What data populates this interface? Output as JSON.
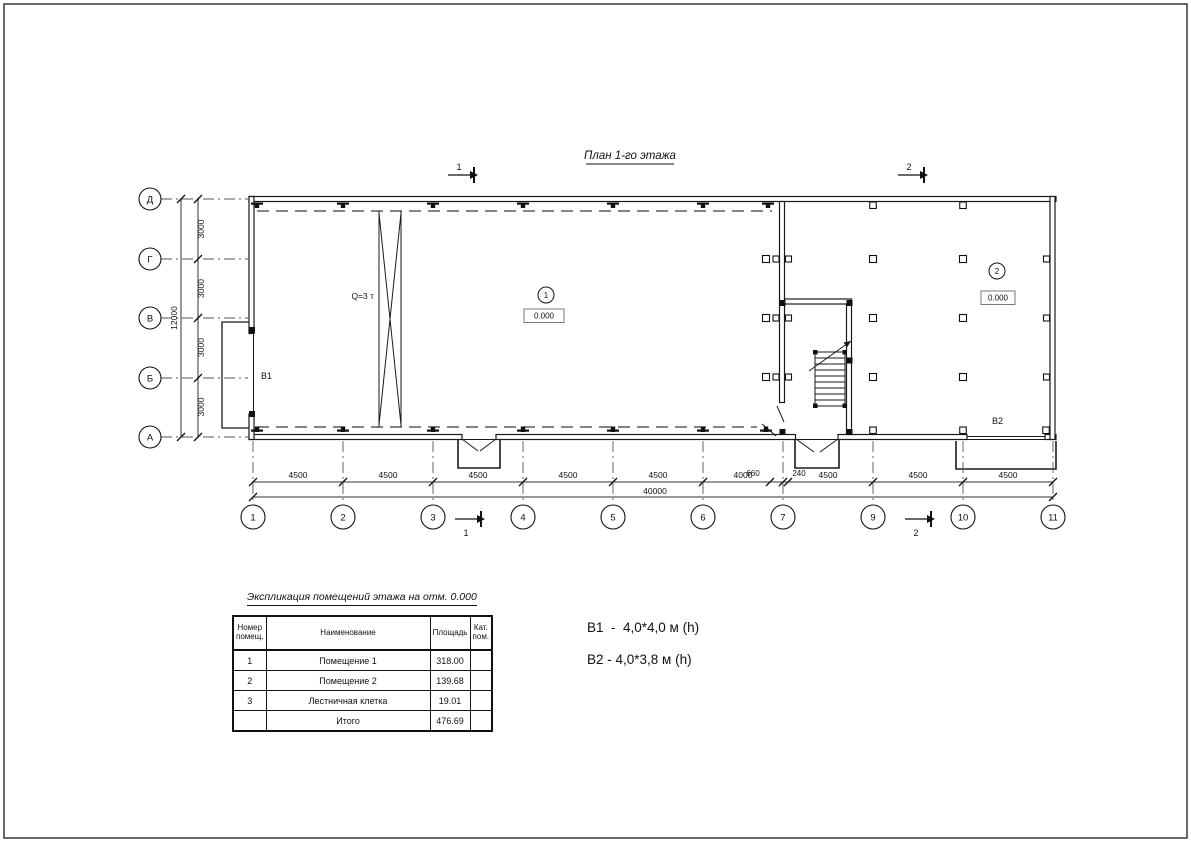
{
  "title": "План 1-го этажа",
  "plan": {
    "axes_cols": [
      "1",
      "2",
      "3",
      "4",
      "5",
      "6",
      "7",
      "9",
      "10",
      "11"
    ],
    "axes_rows": [
      "Д",
      "Г",
      "В",
      "Б",
      "А"
    ],
    "dims_bottom": [
      "4500",
      "4500",
      "4500",
      "4500",
      "4500",
      "4000",
      "4500",
      "4500",
      "4500"
    ],
    "dim_small": [
      "660",
      "240"
    ],
    "dim_total_bottom": "40000",
    "dims_left": [
      "3000",
      "3000",
      "3000",
      "3000"
    ],
    "dim_total_left": "12000",
    "sections": {
      "s1": "1",
      "s2": "2"
    },
    "crane_label": "Q=3 т",
    "room1_marker": "1",
    "room1_level": "0.000",
    "room2_marker": "2",
    "room2_level": "0.000",
    "gate1_label": "В1",
    "gate2_label": "В2"
  },
  "legend": {
    "line1": "В1  -  4,0*4,0 м (h)",
    "line2": "В2 - 4,0*3,8 м (h)"
  },
  "table": {
    "title": "Экспликация помещений этажа на отм. 0.000",
    "headers": {
      "num": "Номер помещ.",
      "name": "Наименование",
      "area": "Площадь",
      "cat": "Кат. пом."
    },
    "rows": [
      {
        "num": "1",
        "name": "Помещение 1",
        "area": "318.00",
        "cat": ""
      },
      {
        "num": "2",
        "name": "Помещение 2",
        "area": "139.68",
        "cat": ""
      },
      {
        "num": "3",
        "name": "Лестничная клетка",
        "area": "19.01",
        "cat": ""
      }
    ],
    "total_label": "Итого",
    "total_area": "476.69"
  },
  "colors": {
    "line": "#111111",
    "dim": "#333333",
    "centerline": "#555555"
  }
}
